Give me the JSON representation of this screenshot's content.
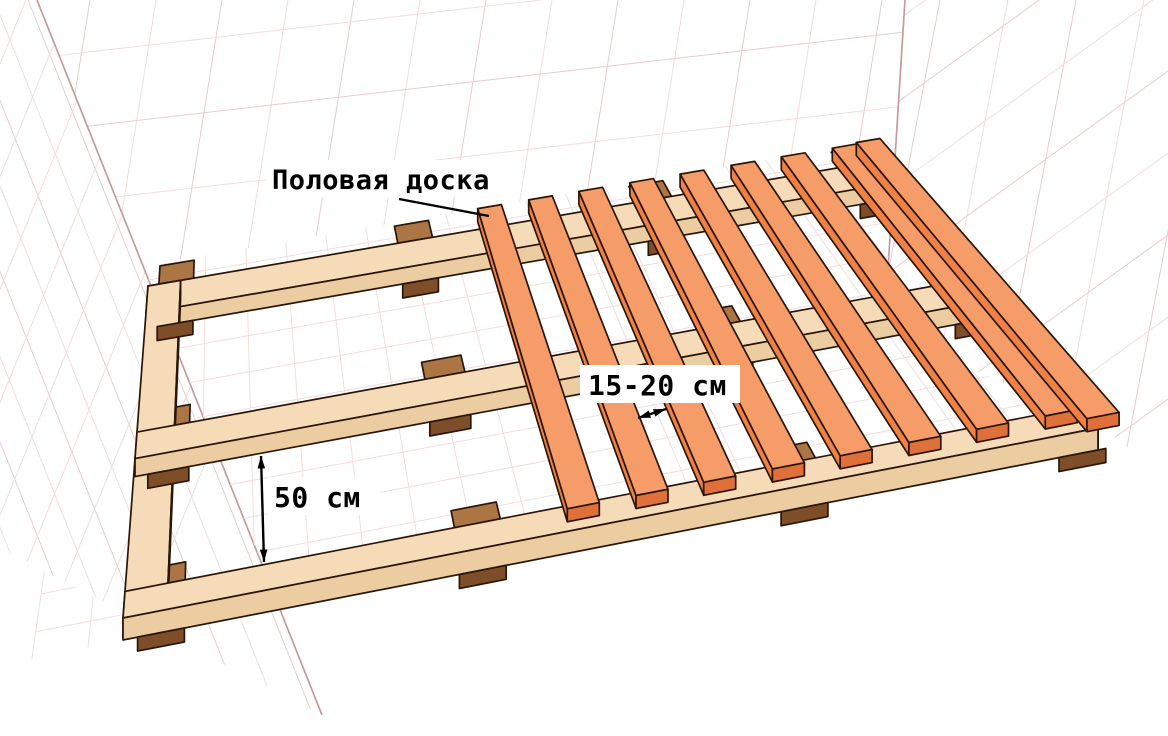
{
  "labels": {
    "floorboard": "Половая доска",
    "board_spacing": "15-20 см",
    "lag_spacing": "50 см"
  },
  "colors": {
    "bg": "#ffffff",
    "board_top": "#f59c68",
    "board_side": "#ef8147",
    "board_end": "#df703a",
    "rail_top": "#f5dbb8",
    "rail_side": "#eccda2",
    "rail_end": "#e3c091",
    "block_top": "#ab7544",
    "block_side": "#7e4e28",
    "grid_light": "#f3dcdc",
    "grid_mid": "#e9cccc",
    "corner_line": "#c49c9c",
    "outline": "#2a1608",
    "text": "#000000"
  }
}
